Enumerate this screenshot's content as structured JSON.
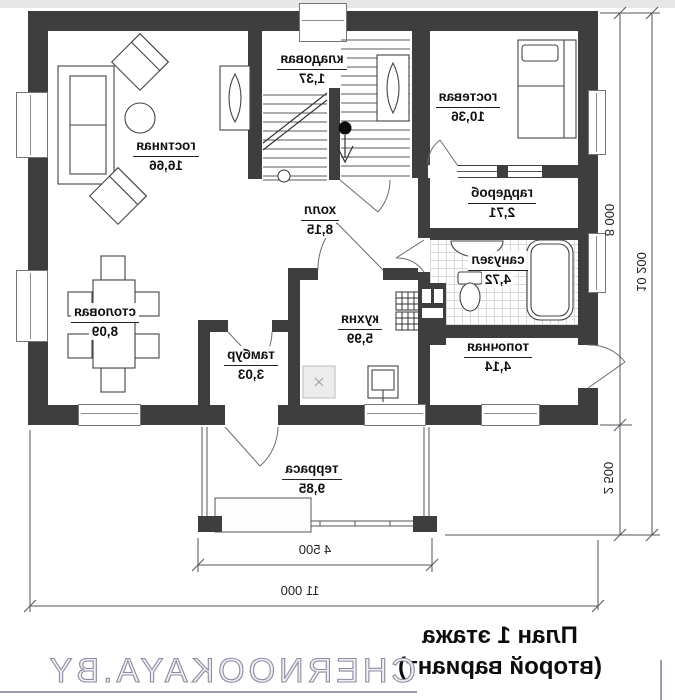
{
  "plan": {
    "wall_color": "#3e3e3e",
    "rooms": [
      {
        "name": "гостиная",
        "area": "16,66"
      },
      {
        "name": "кладовая",
        "area": "1,37"
      },
      {
        "name": "гостевая",
        "area": "10,36"
      },
      {
        "name": "гардероб",
        "area": "2,71"
      },
      {
        "name": "холл",
        "area": "8,15"
      },
      {
        "name": "санузел",
        "area": "4,72"
      },
      {
        "name": "столовая",
        "area": "8,09"
      },
      {
        "name": "кухня",
        "area": "5,99"
      },
      {
        "name": "тамбур",
        "area": "3,03"
      },
      {
        "name": "топочная",
        "area": "4,14"
      },
      {
        "name": "терраса",
        "area": "9,85"
      }
    ],
    "dimensions": {
      "house_height": "8 000",
      "terrace_height": "2 500",
      "total_height": "10 200",
      "terrace_width": "4 500",
      "total_width": "11 000"
    },
    "title": {
      "line1": "План 1 этажа",
      "line2": "(второй вариант)"
    },
    "watermark": "CHERNOOKAYA.BY"
  }
}
